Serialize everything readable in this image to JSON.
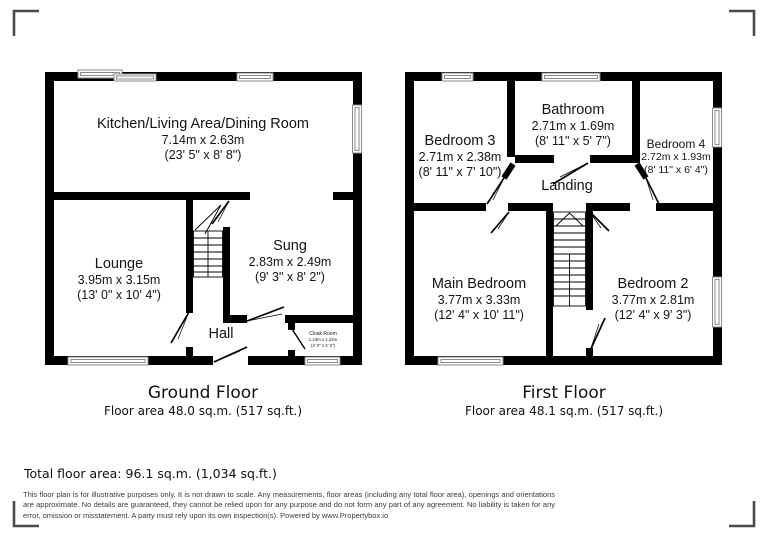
{
  "meta": {
    "wall_color": "#000000",
    "window_stroke": "#8a8a8a",
    "bracket_color": "#4a4a4a",
    "background": "#ffffff"
  },
  "ground_floor": {
    "title": "Ground Floor",
    "area": "Floor area 48.0 sq.m. (517 sq.ft.)",
    "rooms": {
      "kitchen": {
        "name": "Kitchen/Living Area/Dining Room",
        "metric": "7.14m x 2.63m",
        "imperial": "(23' 5\" x 8' 8\")"
      },
      "lounge": {
        "name": "Lounge",
        "metric": "3.95m x 3.15m",
        "imperial": "(13' 0\" x 10' 4\")"
      },
      "sung": {
        "name": "Sung",
        "metric": "2.83m x 2.49m",
        "imperial": "(9' 3\" x 8' 2\")"
      },
      "hall": {
        "name": "Hall"
      },
      "cloak": {
        "name": "Cloak Room",
        "metric": "1.23m x 1.22m",
        "imperial": "(4' 0\" x 4' 0\")"
      }
    }
  },
  "first_floor": {
    "title": "First Floor",
    "area": "Floor area 48.1 sq.m. (517 sq.ft.)",
    "rooms": {
      "bedroom3": {
        "name": "Bedroom 3",
        "metric": "2.71m x 2.38m",
        "imperial": "(8' 11\" x 7' 10\")"
      },
      "bathroom": {
        "name": "Bathroom",
        "metric": "2.71m x 1.69m",
        "imperial": "(8' 11\" x 5' 7\")"
      },
      "bedroom4": {
        "name": "Bedroom 4",
        "metric": "2.72m x 1.93m",
        "imperial": "(8' 11\" x 6' 4\")"
      },
      "landing": {
        "name": "Landing"
      },
      "main_bedroom": {
        "name": "Main Bedroom",
        "metric": "3.77m x 3.33m",
        "imperial": "(12' 4\" x 10' 11\")"
      },
      "bedroom2": {
        "name": "Bedroom 2",
        "metric": "3.77m x 2.81m",
        "imperial": "(12' 4\" x 9' 3\")"
      }
    }
  },
  "footer": {
    "total_area": "Total floor area: 96.1 sq.m. (1,034 sq.ft.)",
    "disclaimer": "This floor plan is for illustrative purposes only. It is not drawn to scale. Any measurements, floor areas (including any total floor area), openings and orientations are approximate. No details are guaranteed, they cannot be relied upon for any purpose and do not form any part of any agreement. No liability is taken for any error, omission or misstatement. A party must rely upon its own inspection(s). Powered by www.Propertybox.io"
  }
}
